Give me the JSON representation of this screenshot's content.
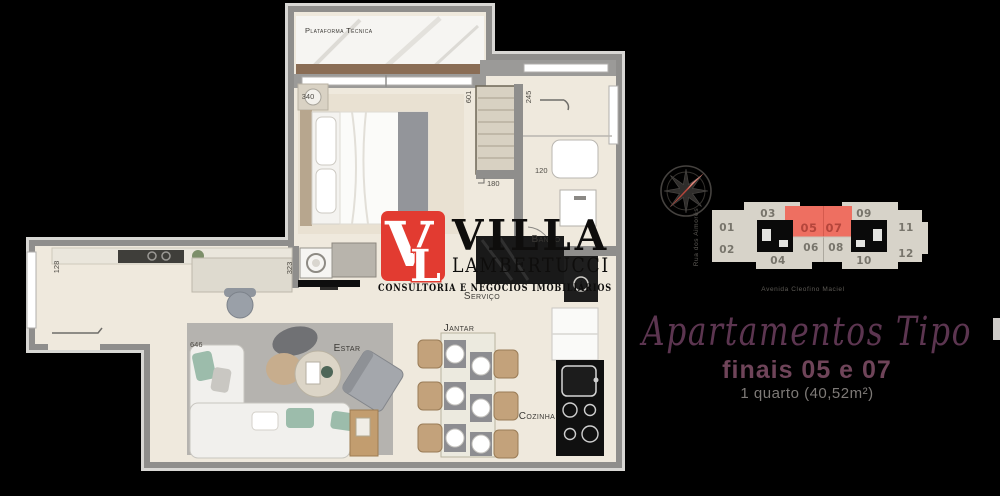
{
  "plan": {
    "room_labels": {
      "plataforma": "Plataforma Técnica",
      "quarto": "Quarto",
      "banho": "Banho",
      "servico": "Serviço",
      "estar": "Estar",
      "jantar": "Jantar",
      "cozinha": "Cozinha"
    },
    "dimensions": {
      "bedroom_wall": "340",
      "closet_wall": "601",
      "bath_wall": "245",
      "bath_jog_a": "120",
      "bath_jog_b": "180",
      "servico_wall": "323",
      "arm_wall": "128",
      "living_wall": "646"
    }
  },
  "logo": {
    "monogram_v": "V",
    "monogram_l": "L",
    "name": "VILLA",
    "surname": "LAMBERTUCCI",
    "tagline": "CONSULTORIA E NEGÓCIOS IMOBILIÁRIOS",
    "brand_red": "#e23b31"
  },
  "panel": {
    "keyplan": {
      "street_left": "Rua dos Aimorés",
      "street_bottom": "Avenida Cleofino Maciel",
      "highlight_color": "#ee6f61",
      "units": [
        {
          "label": "01"
        },
        {
          "label": "02"
        },
        {
          "label": "03"
        },
        {
          "label": "04"
        },
        {
          "label": "05",
          "highlighted": true
        },
        {
          "label": "06"
        },
        {
          "label": "07",
          "highlighted": true
        },
        {
          "label": "08"
        },
        {
          "label": "09"
        },
        {
          "label": "10"
        },
        {
          "label": "11"
        },
        {
          "label": "12"
        }
      ]
    },
    "heading_script": "Apartamentos Tipo",
    "subheading": "finais 05 e 07",
    "unit_info": "1 quarto (40,52m²)"
  }
}
